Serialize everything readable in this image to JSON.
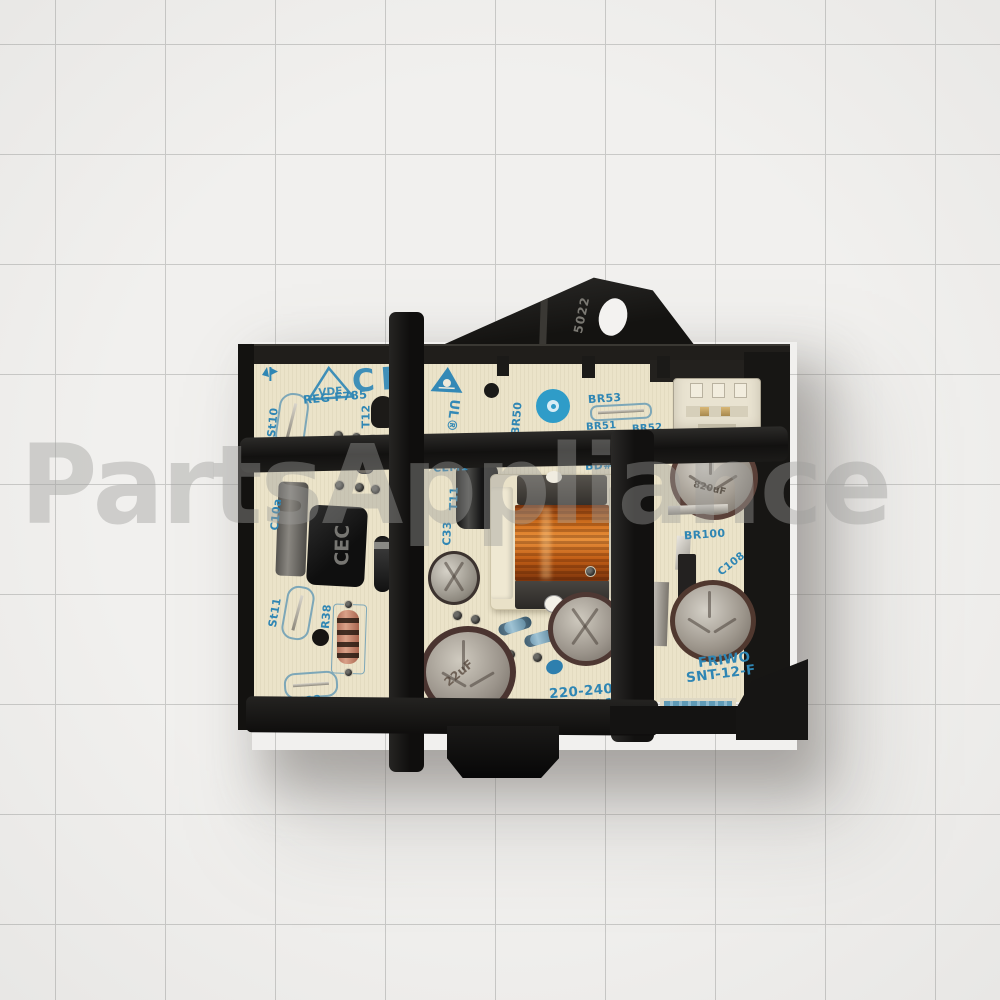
{
  "image_type": "product-photo",
  "subject": "appliance switching power supply circuit board in black mounting frame on grid paper",
  "watermark": {
    "text": "PartsAppliance"
  },
  "bracket": {
    "marking": "5022"
  },
  "pcb": {
    "cert_marks": {
      "vde": "VDE",
      "vde_reg": "REG F785",
      "ce": "CE",
      "ul": "UL®"
    },
    "silkscreen": {
      "st10": "St10",
      "t12": "T12",
      "br50": "BR50",
      "br53": "BR53",
      "br51": "BR51",
      "br52": "BR52",
      "cem1": "CEM1",
      "bd3": "BD#3",
      "t11": "T11",
      "c33": "C33",
      "c10a": "C10a",
      "st11": "St11",
      "r38": "R38",
      "d40": "D40",
      "st12": "St12",
      "br100": "BR100",
      "c108": "C108"
    },
    "component_markings": {
      "cec": "CEC",
      "cap_right_top": "820uF",
      "cap_bottom": "22uF"
    },
    "ratings": {
      "input": "220-240V 50",
      "output": "9,6V / 12,5"
    },
    "manufacturer": {
      "brand": "FRIWO",
      "model": "SNT-12-F"
    }
  },
  "colors": {
    "paper": "#f1f0ee",
    "grid_line": "#c9c9c7",
    "pcb_cream": "#ebe3c9",
    "silkscreen_blue": "#2f86b4",
    "frame_black": "#161514",
    "copper_winding": "#c96a1e"
  }
}
